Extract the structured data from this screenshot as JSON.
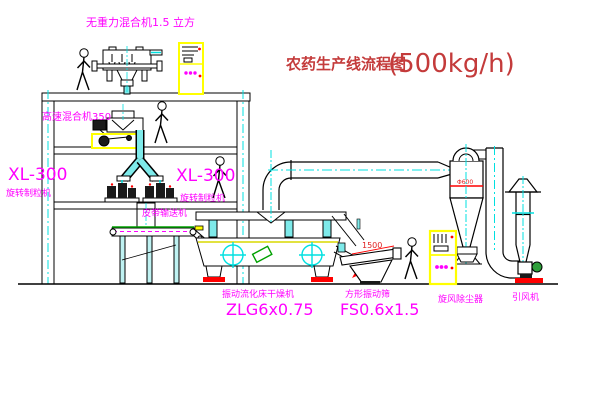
{
  "title": {
    "text": "农药生产线流程图",
    "capacity": "(500kg/h)"
  },
  "labels": {
    "gravityless_mixer": "无重力混合机1.5 立方",
    "high_speed_mixer": "高速混合机350",
    "granulator_model_left": "XL-300",
    "granulator_name_left": "旋转制粒机",
    "granulator_model_mid": "XL-300",
    "granulator_name_mid": "旋转制粒机",
    "belt_conveyor": "皮带输送机",
    "dryer_name": "振动流化床干燥机",
    "dryer_model": "ZLG6x0.75",
    "sieve_name": "方形振动筛",
    "sieve_model": "FS0.6x1.5",
    "cyclone": "旋风除尘器",
    "induced_draft_fan": "引风机"
  },
  "dimensions": {
    "sieve_length": "1500",
    "cyclone_note": "Φ600"
  },
  "colors": {
    "line": "#000000",
    "centerline_cyan": "#00e0e0",
    "pipe_fill_cyan": "#7eeaea",
    "label_magenta": "#ff00ff",
    "title_red": "#c43b3b",
    "accent_red": "#ff0000",
    "cabinet_yellow": "#ffff00",
    "motor_green": "#2e9e3a",
    "belt_green": "#00a000"
  }
}
